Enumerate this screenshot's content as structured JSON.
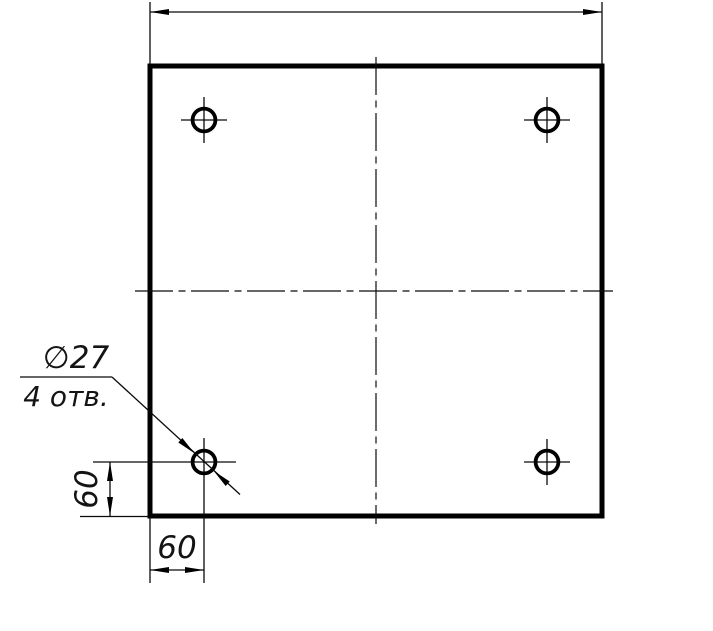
{
  "drawing": {
    "background": "#ffffff",
    "line_color": "#000000",
    "callout": {
      "diameter": "∅27",
      "count": "4 отв."
    },
    "dimensions": {
      "left_vertical": "60",
      "bottom_horizontal": "60",
      "top_overall": ""
    }
  }
}
